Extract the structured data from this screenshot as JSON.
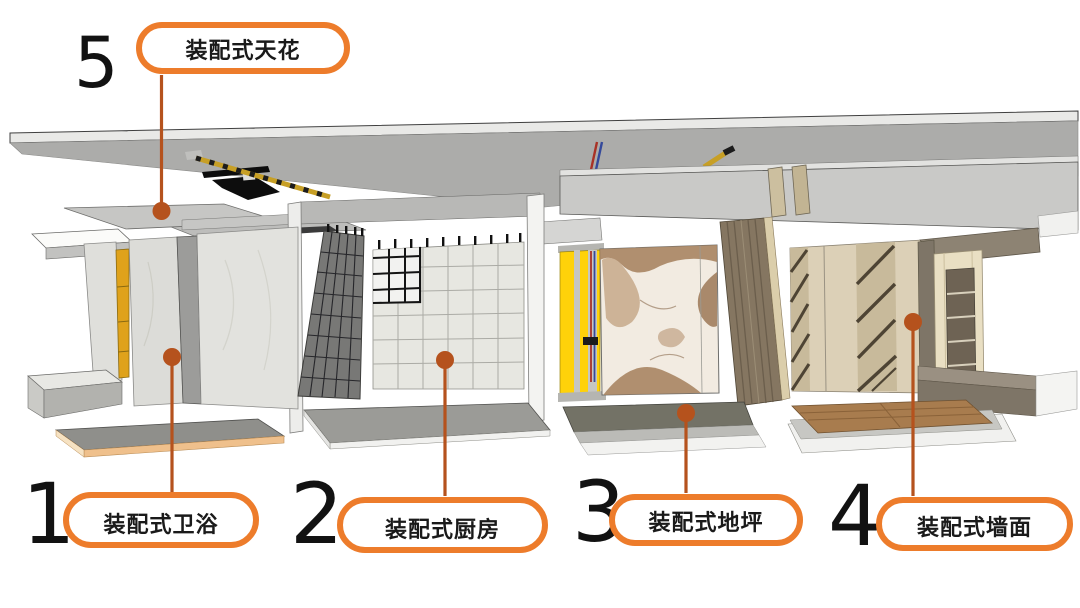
{
  "callouts": [
    {
      "number": "5",
      "label": "装配式天花"
    },
    {
      "number": "1",
      "label": "装配式卫浴"
    },
    {
      "number": "2",
      "label": "装配式厨房"
    },
    {
      "number": "3",
      "label": "装配式地坪"
    },
    {
      "number": "4",
      "label": "装配式墙面"
    }
  ],
  "colors": {
    "pill_border": "#ED7C2B",
    "pill_fill": "#FFFFFF",
    "label_text": "#1A1A1A",
    "number_text": "#121212",
    "leader": "#B5521D",
    "background": "#FFFFFF"
  },
  "scene": {
    "components": [
      "concrete-ceiling-slab",
      "ceiling-cable-tray",
      "ceiling-conduit",
      "ceiling-pipes",
      "suspended-ceiling-panel",
      "ceiling-beam",
      "bathroom-module",
      "kitchen-module",
      "service-riser-module",
      "marble-feature-wall",
      "wood-textured-panel",
      "floor-panel-assembly",
      "paneled-wall-module",
      "shelving-niche",
      "wood-flooring-panel"
    ]
  }
}
